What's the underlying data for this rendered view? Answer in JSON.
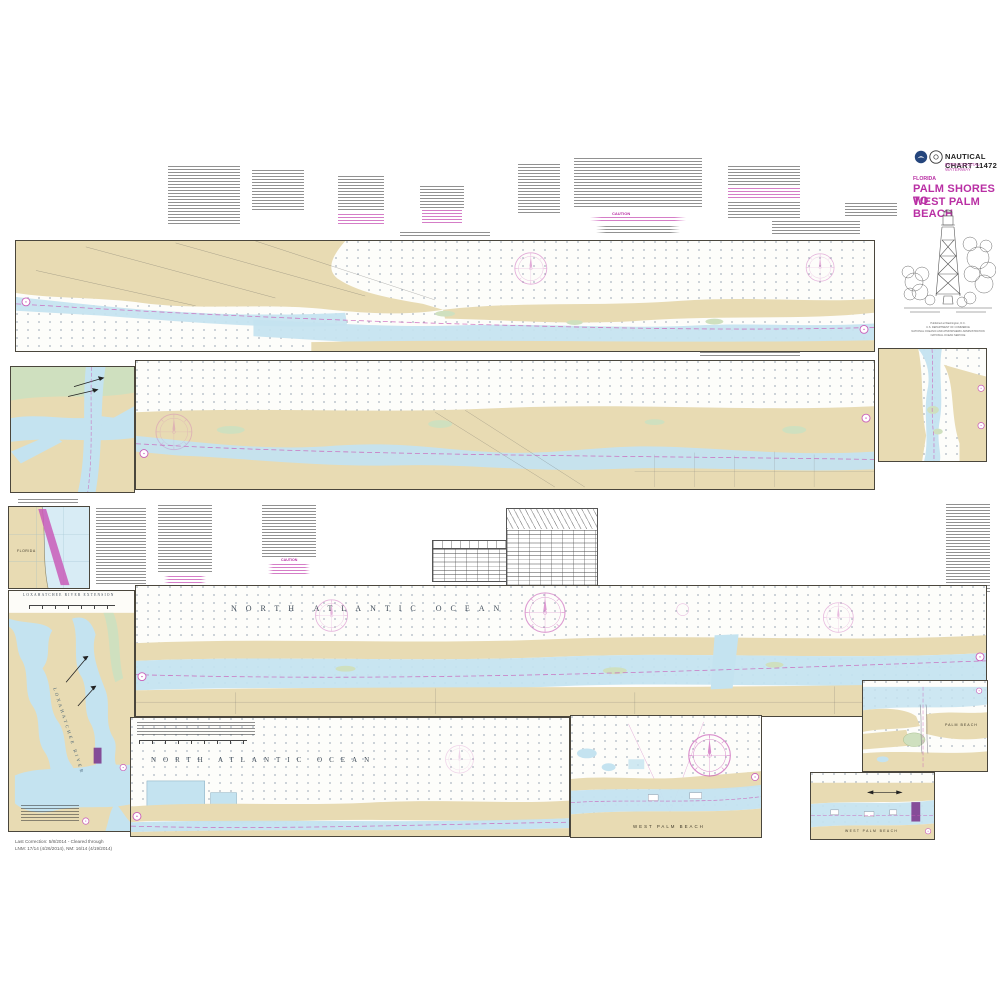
{
  "page_title": "NOAA Nautical Chart 11472 - Palm Shores to West Palm Beach",
  "colors": {
    "land_tan": "#e8dbb3",
    "water_blue": "#c4e3f0",
    "marsh_green": "#cfe0bf",
    "chart_magenta": "#c95cb8",
    "title_magenta": "#b92fa4",
    "restricted_purple": "#7d3b8e",
    "neatline_ink": "#4a463c"
  },
  "header": {
    "chart_number": "NAUTICAL CHART 11472",
    "series": "INTRACOASTAL WATERWAY",
    "state": "FLORIDA",
    "title_line1": "PALM SHORES TO",
    "title_line2": "WEST PALM BEACH",
    "caption_line1": "Published at Washington, D.C.",
    "caption_line2": "U.S. DEPARTMENT OF COMMERCE",
    "caption_line3": "NATIONAL OCEANIC AND ATMOSPHERIC ADMINISTRATION",
    "caption_line4": "NATIONAL OCEAN SERVICE"
  },
  "labels": {
    "ocean": "NORTH ATLANTIC OCEAN",
    "loxahatchee_river": "LOXAHATCHEE RIVER",
    "loxahatchee_title": "LOXAHATCHEE RIVER EXTENSION",
    "west_palm_beach": "WEST PALM BEACH",
    "palm_beach": "PALM BEACH",
    "florida": "FLORIDA",
    "caution": "CAUTION"
  },
  "footer": {
    "line1": "Last Correction: 5/8/2014 - Cleared through",
    "line2": "LNM: 17/14 (4/26/2014), NM: 16/14 (4/19/2014)"
  },
  "icons": {
    "noaa_logo": "noaa-circular-emblem",
    "commerce_logo": "department-of-commerce-seal",
    "lighthouse": "jupiter-inlet-lighthouse-line-art",
    "compass_rose": "magenta-compass-rose",
    "north_arrow": "north-arrow",
    "match_marker": "magenta-circled-join-marker"
  }
}
